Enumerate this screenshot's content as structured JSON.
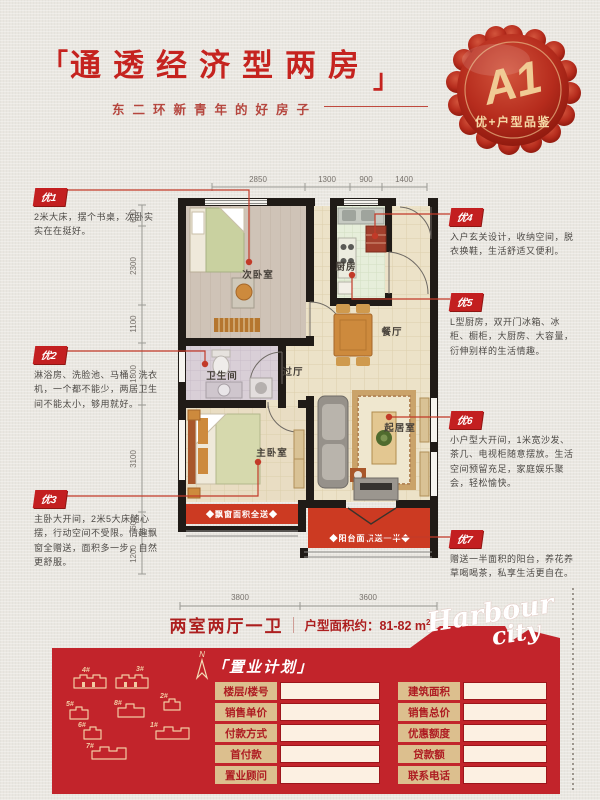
{
  "colors": {
    "accent_red": "#c5231f",
    "footer_red": "#c2242b",
    "badge_gold": "#f0cb95",
    "balcony_red": "#cc3a22"
  },
  "header": {
    "bracket_left": "「",
    "bracket_right": "」",
    "title": "通透经济型两房",
    "subtitle": "东二环新青年的好房子"
  },
  "badge": {
    "code": "A1",
    "label": "优+户型品鉴"
  },
  "callouts": [
    {
      "id": "优1",
      "text": "2米大床，摆个书桌，次卧实实在在挺好。"
    },
    {
      "id": "优2",
      "text": "淋浴房、洗脸池、马桶、洗衣机，一个都不能少，两居卫生间不能太小，够用就好。"
    },
    {
      "id": "优3",
      "text": "主卧大开间，2米5大床随心摆，行动空间不受限。情趣飘窗全赠送，面积多一步，自然更舒服。"
    },
    {
      "id": "优4",
      "text": "入户玄关设计，收纳空间，脱衣换鞋，生活舒适又便利。"
    },
    {
      "id": "优5",
      "text": "L型厨房，双开门冰箱、冰柜、橱柜，大厨房、大容量，衍伸别样的生活情趣。"
    },
    {
      "id": "优6",
      "text": "小户型大开间，1米宽沙发、茶几、电视柜随意摆放。生活空间预留充足，家庭娱乐聚会，轻松愉快。"
    },
    {
      "id": "优7",
      "text": "赠送一半面积的阳台，养花养草喝喝茶，私享生活更自在。"
    }
  ],
  "floorplan": {
    "rooms": {
      "bedroom2": "次卧室",
      "kitchen": "厨房",
      "dining": "餐厅",
      "hall": "过厅",
      "bathroom": "卫生间",
      "master": "主卧室",
      "living": "起居室"
    },
    "gifts": {
      "bay": "◆飘窗面积全送◆",
      "balcony": "◆阳台面积送一半◆"
    },
    "dims": {
      "top": [
        "2850",
        "1300",
        "900",
        "1400"
      ],
      "left": [
        "600",
        "2300",
        "1100",
        "1800",
        "3100",
        "600",
        "1200"
      ],
      "bottom": [
        "3800",
        "3600"
      ]
    }
  },
  "summary": {
    "rooms": "两室两厅一卫",
    "area": "户型面积约：81-82 m",
    "area_sup": "2"
  },
  "footer": {
    "plan_title": "「置业计划」",
    "compass": "N",
    "logo_line1": "Harbour",
    "logo_line2": "city",
    "table": [
      {
        "l": "楼层/楼号",
        "r": "建筑面积"
      },
      {
        "l": "销售单价",
        "r": "销售总价"
      },
      {
        "l": "付款方式",
        "r": "优惠额度"
      },
      {
        "l": "首付款",
        "r": "贷款额"
      },
      {
        "l": "置业顾问",
        "r": "联系电话"
      }
    ],
    "buildings": [
      "1#",
      "2#",
      "3#",
      "4#",
      "5#",
      "6#",
      "7#",
      "8#"
    ]
  }
}
